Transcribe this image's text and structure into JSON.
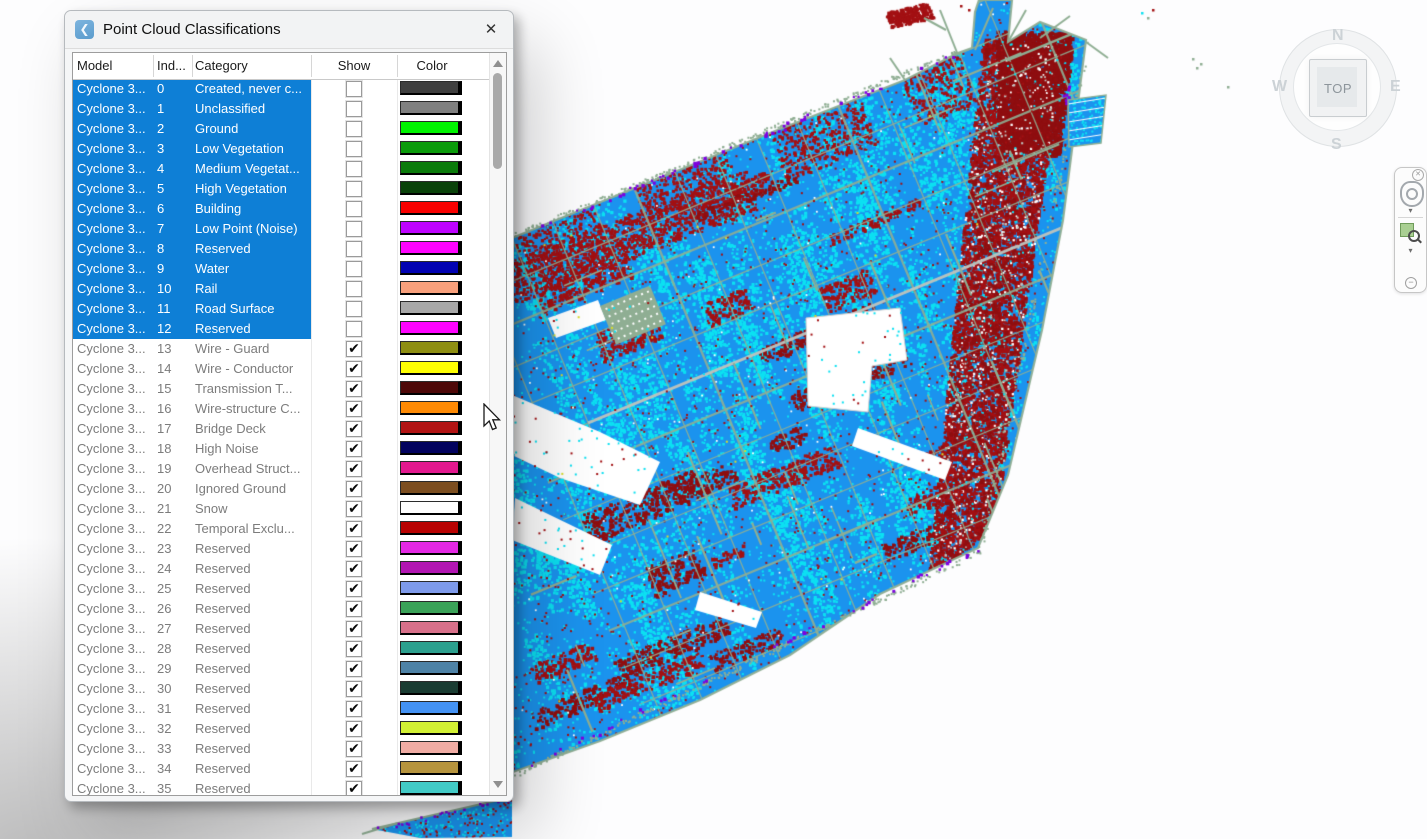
{
  "dialog": {
    "title": "Point Cloud Classifications",
    "close_label": "✕",
    "app_icon_glyph": "❮",
    "columns": {
      "model": "Model",
      "index": "Ind...",
      "category": "Category",
      "show": "Show",
      "color": "Color"
    },
    "rows": [
      {
        "model": "Cyclone 3...",
        "index": "0",
        "category": "Created, never c...",
        "show": false,
        "selected": true,
        "color": "#3F3F3F"
      },
      {
        "model": "Cyclone 3...",
        "index": "1",
        "category": "Unclassified",
        "show": false,
        "selected": true,
        "color": "#808080"
      },
      {
        "model": "Cyclone 3...",
        "index": "2",
        "category": "Ground",
        "show": false,
        "selected": true,
        "color": "#00F400"
      },
      {
        "model": "Cyclone 3...",
        "index": "3",
        "category": "Low Vegetation",
        "show": false,
        "selected": true,
        "color": "#0B9B0B"
      },
      {
        "model": "Cyclone 3...",
        "index": "4",
        "category": "Medium Vegetat...",
        "show": false,
        "selected": true,
        "color": "#0B7B0B"
      },
      {
        "model": "Cyclone 3...",
        "index": "5",
        "category": "High Vegetation",
        "show": false,
        "selected": true,
        "color": "#0A420A"
      },
      {
        "model": "Cyclone 3...",
        "index": "6",
        "category": "Building",
        "show": false,
        "selected": true,
        "color": "#F80000"
      },
      {
        "model": "Cyclone 3...",
        "index": "7",
        "category": "Low Point (Noise)",
        "show": false,
        "selected": true,
        "color": "#BE02FE"
      },
      {
        "model": "Cyclone 3...",
        "index": "8",
        "category": "Reserved",
        "show": false,
        "selected": true,
        "color": "#FE02FE"
      },
      {
        "model": "Cyclone 3...",
        "index": "9",
        "category": "Water",
        "show": false,
        "selected": true,
        "color": "#0202B2"
      },
      {
        "model": "Cyclone 3...",
        "index": "10",
        "category": "Rail",
        "show": false,
        "selected": true,
        "color": "#F8A07C"
      },
      {
        "model": "Cyclone 3...",
        "index": "11",
        "category": "Road Surface",
        "show": false,
        "selected": true,
        "color": "#A8A8A8"
      },
      {
        "model": "Cyclone 3...",
        "index": "12",
        "category": "Reserved",
        "show": false,
        "selected": true,
        "color": "#FE02FE"
      },
      {
        "model": "Cyclone 3...",
        "index": "13",
        "category": "Wire - Guard",
        "show": true,
        "selected": false,
        "color": "#8E8E12"
      },
      {
        "model": "Cyclone 3...",
        "index": "14",
        "category": "Wire - Conductor",
        "show": true,
        "selected": false,
        "color": "#FEFE02"
      },
      {
        "model": "Cyclone 3...",
        "index": "15",
        "category": "Transmission T...",
        "show": true,
        "selected": false,
        "color": "#4E0808"
      },
      {
        "model": "Cyclone 3...",
        "index": "16",
        "category": "Wire-structure C...",
        "show": true,
        "selected": false,
        "color": "#FE8A04"
      },
      {
        "model": "Cyclone 3...",
        "index": "17",
        "category": "Bridge Deck",
        "show": true,
        "selected": false,
        "color": "#B21414"
      },
      {
        "model": "Cyclone 3...",
        "index": "18",
        "category": "High Noise",
        "show": true,
        "selected": false,
        "color": "#02025E"
      },
      {
        "model": "Cyclone 3...",
        "index": "19",
        "category": "Overhead Struct...",
        "show": true,
        "selected": false,
        "color": "#E2188E"
      },
      {
        "model": "Cyclone 3...",
        "index": "20",
        "category": "Ignored Ground",
        "show": true,
        "selected": false,
        "color": "#7C4E20"
      },
      {
        "model": "Cyclone 3...",
        "index": "21",
        "category": "Snow",
        "show": true,
        "selected": false,
        "color": "#FEFEFE"
      },
      {
        "model": "Cyclone 3...",
        "index": "22",
        "category": "Temporal Exclu...",
        "show": true,
        "selected": false,
        "color": "#B80202"
      },
      {
        "model": "Cyclone 3...",
        "index": "23",
        "category": "Reserved",
        "show": true,
        "selected": false,
        "color": "#E428E4"
      },
      {
        "model": "Cyclone 3...",
        "index": "24",
        "category": "Reserved",
        "show": true,
        "selected": false,
        "color": "#B216B2"
      },
      {
        "model": "Cyclone 3...",
        "index": "25",
        "category": "Reserved",
        "show": true,
        "selected": false,
        "color": "#7E9AEA"
      },
      {
        "model": "Cyclone 3...",
        "index": "26",
        "category": "Reserved",
        "show": true,
        "selected": false,
        "color": "#3AA258"
      },
      {
        "model": "Cyclone 3...",
        "index": "27",
        "category": "Reserved",
        "show": true,
        "selected": false,
        "color": "#D8708A"
      },
      {
        "model": "Cyclone 3...",
        "index": "28",
        "category": "Reserved",
        "show": true,
        "selected": false,
        "color": "#2CA08E"
      },
      {
        "model": "Cyclone 3...",
        "index": "29",
        "category": "Reserved",
        "show": true,
        "selected": false,
        "color": "#4E82A6"
      },
      {
        "model": "Cyclone 3...",
        "index": "30",
        "category": "Reserved",
        "show": true,
        "selected": false,
        "color": "#1A3C32"
      },
      {
        "model": "Cyclone 3...",
        "index": "31",
        "category": "Reserved",
        "show": true,
        "selected": false,
        "color": "#4492F4"
      },
      {
        "model": "Cyclone 3...",
        "index": "32",
        "category": "Reserved",
        "show": true,
        "selected": false,
        "color": "#D2F034"
      },
      {
        "model": "Cyclone 3...",
        "index": "33",
        "category": "Reserved",
        "show": true,
        "selected": false,
        "color": "#F0ACA4"
      },
      {
        "model": "Cyclone 3...",
        "index": "34",
        "category": "Reserved",
        "show": true,
        "selected": false,
        "color": "#B6943E"
      },
      {
        "model": "Cyclone 3...",
        "index": "35",
        "category": "Reserved",
        "show": true,
        "selected": false,
        "color": "#42CAC6"
      }
    ]
  },
  "viewcube": {
    "north": "N",
    "south": "S",
    "east": "E",
    "west": "W",
    "face_label": "TOP"
  },
  "point_cloud": {
    "palette": {
      "base": "#1B93EE",
      "cyan": "#0CE1F2",
      "red": "#A31013",
      "darkred": "#8F0E10",
      "sage": "#8FAE93",
      "white": "#FFFFFF",
      "purple": "#7D00E0",
      "gray": "#C0C4C0",
      "yellow": "#D8DC2A"
    }
  }
}
